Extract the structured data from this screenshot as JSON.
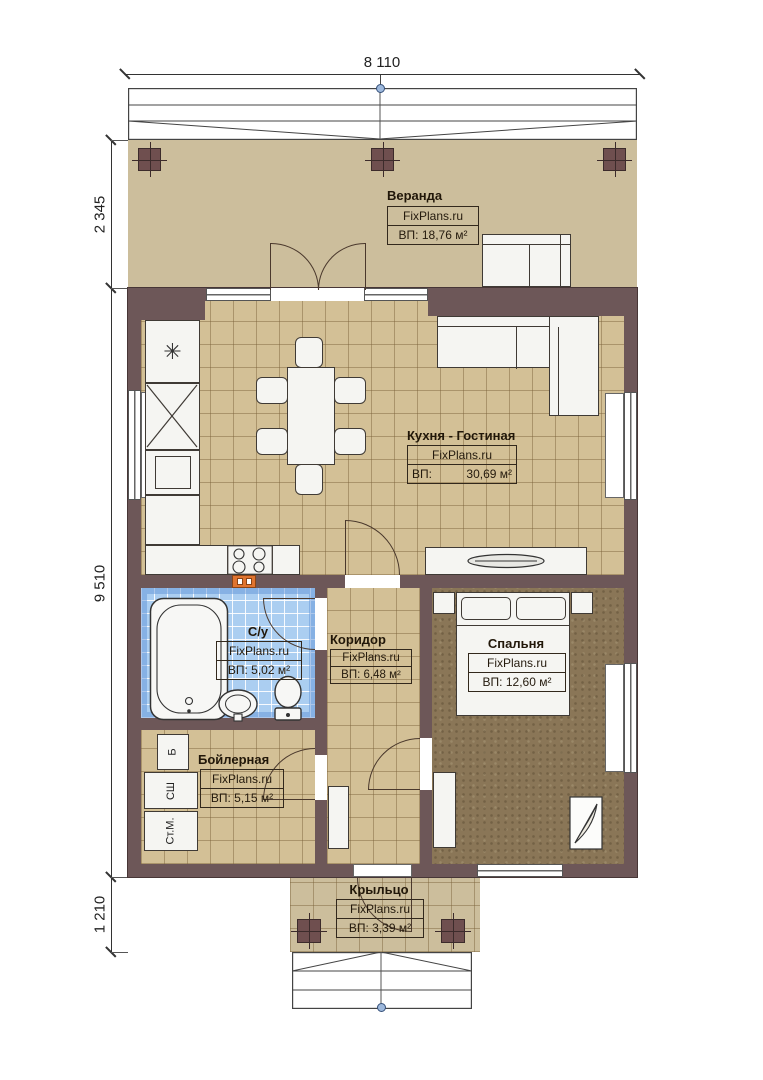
{
  "watermark": "FixPlans.ru",
  "dimensions": {
    "top_width": "8 110",
    "veranda_depth": "2 345",
    "house_depth": "9 510",
    "porch_depth": "1 210"
  },
  "rooms": {
    "veranda": {
      "name": "Веранда",
      "area": "ВП: 18,76 м²"
    },
    "kitchen": {
      "name": "Кухня - Гостиная",
      "area_label": "ВП:",
      "area_value": "30,69 м²"
    },
    "bath": {
      "name": "С/у",
      "area": "ВП: 5,02 м²"
    },
    "corridor": {
      "name": "Коридор",
      "area": "ВП: 6,48 м²"
    },
    "bedroom": {
      "name": "Спальня",
      "area": "ВП: 12,60 м²"
    },
    "boiler": {
      "name": "Бойлерная",
      "area": "ВП: 5,15 м²"
    },
    "porch": {
      "name": "Крыльцо",
      "area": "ВП: 3,39 м²"
    }
  },
  "appliances": {
    "boiler_unit": "Б",
    "dryer": "СШ",
    "washer": "Ст.М."
  },
  "symbols": {
    "cooktop_star": "✳"
  },
  "colors": {
    "wall": "#6d5758",
    "tile_floor": "#d3c096",
    "bath_tile": "#abcef1",
    "bedroom_floor": "#8a7657",
    "veranda_floor": "#ccbe9c",
    "flue_accent": "#e0742f"
  }
}
